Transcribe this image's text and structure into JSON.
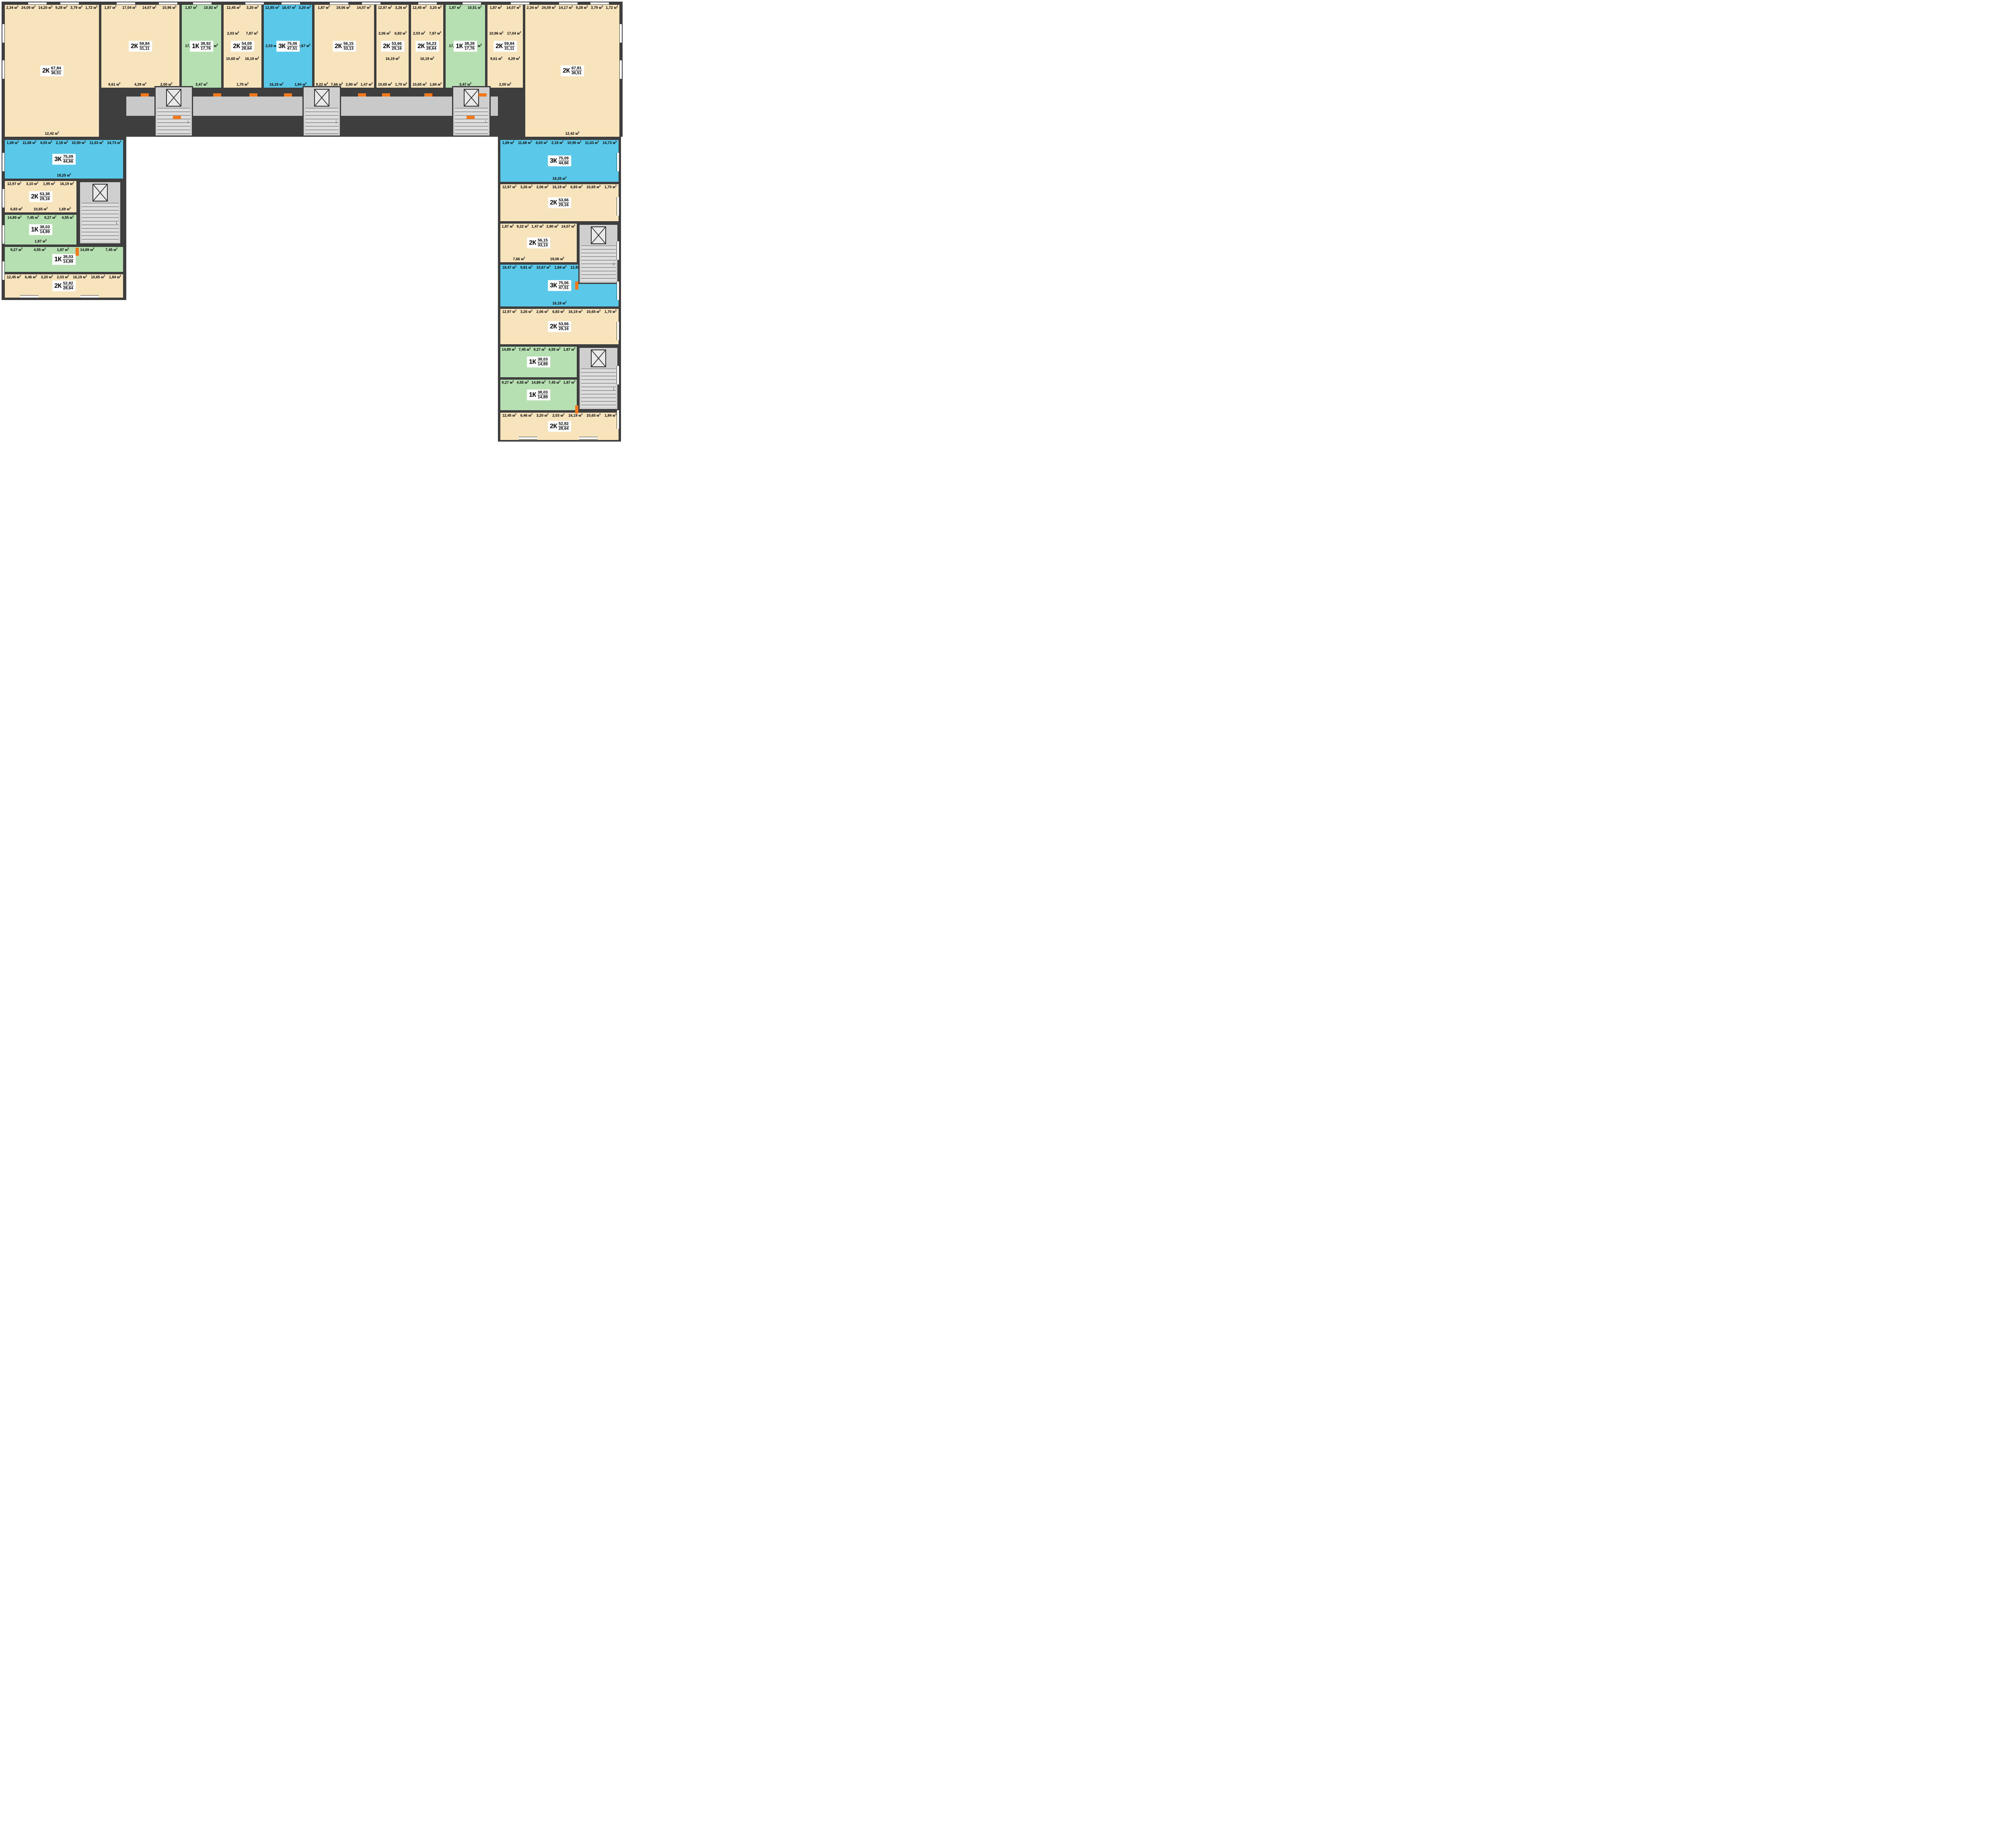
{
  "unit": "м²",
  "colors": {
    "wall": "#3e3e3e",
    "room_beige": "#f7e3bc",
    "room_green": "#b7e0b2",
    "room_blue": "#5ac8e8",
    "corridor_gray": "#c9c9c9",
    "accent_orange": "#f2781a",
    "badge_bg": "#ffffff",
    "text": "#000000"
  },
  "apartments": [
    {
      "id": "top-1",
      "type": "2К",
      "total": "67,84",
      "living": "36,51",
      "palette": "beige",
      "rooms": [
        {
          "name": "balcony",
          "area": "2,34"
        },
        {
          "name": "living-room",
          "area": "24,09"
        },
        {
          "name": "kitchen",
          "area": "14,20"
        },
        {
          "name": "hallway",
          "area": "9,28"
        },
        {
          "name": "bathroom",
          "area": "3,79"
        },
        {
          "name": "wc",
          "area": "1,72"
        },
        {
          "name": "living-room",
          "area": "12,42"
        }
      ]
    },
    {
      "id": "top-2",
      "type": "2К",
      "total": "59,84",
      "living": "31,11",
      "palette": "beige",
      "rooms": [
        {
          "name": "balcony",
          "area": "1,87"
        },
        {
          "name": "living-room",
          "area": "17,04"
        },
        {
          "name": "living-room",
          "area": "14,07"
        },
        {
          "name": "kitchen",
          "area": "10,96"
        },
        {
          "name": "hallway",
          "area": "9,61"
        },
        {
          "name": "bathroom",
          "area": "4,29"
        },
        {
          "name": "wc",
          "area": "2,00"
        }
      ]
    },
    {
      "id": "top-3",
      "type": "1К",
      "total": "38,92",
      "living": "17,76",
      "palette": "green",
      "rooms": [
        {
          "name": "balcony",
          "area": "1,87"
        },
        {
          "name": "kitchen",
          "area": "10,92"
        },
        {
          "name": "living-room",
          "area": "17,76"
        },
        {
          "name": "bathroom",
          "area": "4,90"
        },
        {
          "name": "hallway",
          "area": "3,47"
        }
      ]
    },
    {
      "id": "top-4",
      "type": "2К",
      "total": "54,09",
      "living": "28,64",
      "palette": "beige",
      "rooms": [
        {
          "name": "living-room",
          "area": "12,45"
        },
        {
          "name": "bathroom",
          "area": "3,20"
        },
        {
          "name": "wc",
          "area": "2,03"
        },
        {
          "name": "hallway",
          "area": "7,87"
        },
        {
          "name": "kitchen",
          "area": "10,65"
        },
        {
          "name": "living-room",
          "area": "16,19"
        },
        {
          "name": "balcony",
          "area": "1,70"
        }
      ]
    },
    {
      "id": "top-5",
      "type": "3К",
      "total": "75,06",
      "living": "47,51",
      "palette": "blue",
      "rooms": [
        {
          "name": "living-room",
          "area": "12,85"
        },
        {
          "name": "living-room",
          "area": "18,47"
        },
        {
          "name": "bathroom",
          "area": "3,20"
        },
        {
          "name": "wc",
          "area": "2,03"
        },
        {
          "name": "hallway",
          "area": "9,81"
        },
        {
          "name": "kitchen",
          "area": "10,67"
        },
        {
          "name": "living-room",
          "area": "16,19"
        },
        {
          "name": "balcony",
          "area": "1,84"
        }
      ]
    },
    {
      "id": "top-6",
      "type": "2К",
      "total": "56,15",
      "living": "33,13",
      "palette": "beige",
      "rooms": [
        {
          "name": "balcony",
          "area": "1,87"
        },
        {
          "name": "living-room",
          "area": "19,06"
        },
        {
          "name": "living-room",
          "area": "14,07"
        },
        {
          "name": "kitchen",
          "area": "9,22"
        },
        {
          "name": "hallway",
          "area": "7,66"
        },
        {
          "name": "bathroom",
          "area": "2,80"
        },
        {
          "name": "wc",
          "area": "1,47"
        }
      ]
    },
    {
      "id": "top-7",
      "type": "2К",
      "total": "53,66",
      "living": "29,16",
      "palette": "beige",
      "rooms": [
        {
          "name": "living-room",
          "area": "12,97"
        },
        {
          "name": "bathroom",
          "area": "3,26"
        },
        {
          "name": "wc",
          "area": "2,06"
        },
        {
          "name": "hallway",
          "area": "6,83"
        },
        {
          "name": "living-room",
          "area": "16,19"
        },
        {
          "name": "kitchen",
          "area": "10,65"
        },
        {
          "name": "balcony",
          "area": "1,70"
        }
      ]
    },
    {
      "id": "top-8",
      "type": "2К",
      "total": "54,23",
      "living": "28,64",
      "palette": "beige",
      "rooms": [
        {
          "name": "living-room",
          "area": "12,45"
        },
        {
          "name": "bathroom",
          "area": "3,20"
        },
        {
          "name": "wc",
          "area": "2,03"
        },
        {
          "name": "hallway",
          "area": "7,87"
        },
        {
          "name": "living-room",
          "area": "16,19"
        },
        {
          "name": "kitchen",
          "area": "10,65"
        },
        {
          "name": "balcony",
          "area": "1,84"
        }
      ]
    },
    {
      "id": "top-9",
      "type": "1К",
      "total": "38,28",
      "living": "17,76",
      "palette": "green",
      "rooms": [
        {
          "name": "balcony",
          "area": "1,87"
        },
        {
          "name": "kitchen",
          "area": "10,51"
        },
        {
          "name": "living-room",
          "area": "17,76"
        },
        {
          "name": "bathroom",
          "area": "4,67"
        },
        {
          "name": "hallway",
          "area": "3,47"
        }
      ]
    },
    {
      "id": "top-10",
      "type": "2К",
      "total": "59,84",
      "living": "31,11",
      "palette": "beige",
      "rooms": [
        {
          "name": "balcony",
          "area": "1,87"
        },
        {
          "name": "living-room",
          "area": "14,07"
        },
        {
          "name": "kitchen",
          "area": "10,96"
        },
        {
          "name": "living-room",
          "area": "17,04"
        },
        {
          "name": "hallway",
          "area": "9,61"
        },
        {
          "name": "bathroom",
          "area": "4,29"
        },
        {
          "name": "wc",
          "area": "2,00"
        }
      ]
    },
    {
      "id": "top-11",
      "type": "2К",
      "total": "67,81",
      "living": "36,51",
      "palette": "beige",
      "rooms": [
        {
          "name": "balcony",
          "area": "2,34"
        },
        {
          "name": "living-room",
          "area": "24,09"
        },
        {
          "name": "kitchen",
          "area": "14,17"
        },
        {
          "name": "hallway",
          "area": "9,28"
        },
        {
          "name": "bathroom",
          "area": "3,79"
        },
        {
          "name": "wc",
          "area": "1,72"
        },
        {
          "name": "living-room",
          "area": "12,42"
        }
      ]
    },
    {
      "id": "left-1",
      "type": "3К",
      "total": "75,09",
      "living": "44,66",
      "palette": "blue",
      "rooms": [
        {
          "name": "balcony",
          "area": "1,69"
        },
        {
          "name": "living-room",
          "area": "11,68"
        },
        {
          "name": "bathroom",
          "area": "4,03"
        },
        {
          "name": "wc",
          "area": "2,18"
        },
        {
          "name": "kitchen",
          "area": "10,90"
        },
        {
          "name": "hallway",
          "area": "11,63"
        },
        {
          "name": "living-room",
          "area": "14,73"
        },
        {
          "name": "living-room",
          "area": "18,25"
        }
      ]
    },
    {
      "id": "left-2",
      "type": "2К",
      "total": "53,38",
      "living": "29,16",
      "palette": "beige",
      "rooms": [
        {
          "name": "living-room",
          "area": "12,97"
        },
        {
          "name": "bathroom",
          "area": "3,10"
        },
        {
          "name": "wc",
          "area": "1,95"
        },
        {
          "name": "living-room",
          "area": "16,19"
        },
        {
          "name": "hallway",
          "area": "6,83"
        },
        {
          "name": "kitchen",
          "area": "10,65"
        },
        {
          "name": "balcony",
          "area": "1,69"
        }
      ]
    },
    {
      "id": "left-3",
      "type": "1К",
      "total": "38,03",
      "living": "14,89",
      "palette": "green",
      "rooms": [
        {
          "name": "living-room",
          "area": "14,89"
        },
        {
          "name": "hallway",
          "area": "7,45"
        },
        {
          "name": "kitchen",
          "area": "9,27"
        },
        {
          "name": "bathroom",
          "area": "4,55"
        },
        {
          "name": "balcony",
          "area": "1,87"
        }
      ]
    },
    {
      "id": "left-4",
      "type": "1К",
      "total": "38,03",
      "living": "14,89",
      "palette": "green",
      "rooms": [
        {
          "name": "kitchen",
          "area": "9,27"
        },
        {
          "name": "bathroom",
          "area": "4,55"
        },
        {
          "name": "balcony",
          "area": "1,87"
        },
        {
          "name": "living-room",
          "area": "14,89"
        },
        {
          "name": "hallway",
          "area": "7,45"
        }
      ]
    },
    {
      "id": "left-5",
      "type": "2К",
      "total": "52,82",
      "living": "28,64",
      "palette": "beige",
      "rooms": [
        {
          "name": "living-room",
          "area": "12,45"
        },
        {
          "name": "hallway",
          "area": "6,46"
        },
        {
          "name": "bathroom",
          "area": "3,20"
        },
        {
          "name": "wc",
          "area": "2,03"
        },
        {
          "name": "living-room",
          "area": "16,19"
        },
        {
          "name": "kitchen",
          "area": "10,65"
        },
        {
          "name": "balcony",
          "area": "1,84"
        }
      ]
    },
    {
      "id": "right-1",
      "type": "3К",
      "total": "75,09",
      "living": "44,66",
      "palette": "blue",
      "rooms": [
        {
          "name": "balcony",
          "area": "1,69"
        },
        {
          "name": "living-room",
          "area": "11,68"
        },
        {
          "name": "bathroom",
          "area": "4,03"
        },
        {
          "name": "wc",
          "area": "2,18"
        },
        {
          "name": "kitchen",
          "area": "10,90"
        },
        {
          "name": "hallway",
          "area": "11,63"
        },
        {
          "name": "living-room",
          "area": "14,73"
        },
        {
          "name": "living-room",
          "area": "18,25"
        }
      ]
    },
    {
      "id": "right-2",
      "type": "2К",
      "total": "53,66",
      "living": "29,16",
      "palette": "beige",
      "rooms": [
        {
          "name": "living-room",
          "area": "12,97"
        },
        {
          "name": "bathroom",
          "area": "3,26"
        },
        {
          "name": "wc",
          "area": "2,06"
        },
        {
          "name": "living-room",
          "area": "16,19"
        },
        {
          "name": "hallway",
          "area": "6,83"
        },
        {
          "name": "kitchen",
          "area": "10,65"
        },
        {
          "name": "balcony",
          "area": "1,70"
        }
      ]
    },
    {
      "id": "right-3",
      "type": "2К",
      "total": "56,15",
      "living": "33,13",
      "palette": "beige",
      "rooms": [
        {
          "name": "balcony",
          "area": "1,87"
        },
        {
          "name": "kitchen",
          "area": "9,22"
        },
        {
          "name": "wc",
          "area": "1,47"
        },
        {
          "name": "bathroom",
          "area": "2,80"
        },
        {
          "name": "living-room",
          "area": "14,07"
        },
        {
          "name": "hallway",
          "area": "7,66"
        },
        {
          "name": "living-room",
          "area": "19,06"
        }
      ]
    },
    {
      "id": "right-4",
      "type": "3К",
      "total": "75,06",
      "living": "47,51",
      "palette": "blue",
      "rooms": [
        {
          "name": "living-room",
          "area": "18,47"
        },
        {
          "name": "hallway",
          "area": "9,81"
        },
        {
          "name": "kitchen",
          "area": "10,67"
        },
        {
          "name": "balcony",
          "area": "1,84"
        },
        {
          "name": "living-room",
          "area": "12,85"
        },
        {
          "name": "bathroom",
          "area": "3,20"
        },
        {
          "name": "wc",
          "area": "2,03"
        },
        {
          "name": "living-room",
          "area": "16,19"
        }
      ]
    },
    {
      "id": "right-5",
      "type": "2К",
      "total": "53,66",
      "living": "29,16",
      "palette": "beige",
      "rooms": [
        {
          "name": "living-room",
          "area": "12,97"
        },
        {
          "name": "bathroom",
          "area": "3,26"
        },
        {
          "name": "wc",
          "area": "2,06"
        },
        {
          "name": "hallway",
          "area": "6,83"
        },
        {
          "name": "living-room",
          "area": "16,19"
        },
        {
          "name": "kitchen",
          "area": "10,65"
        },
        {
          "name": "balcony",
          "area": "1,70"
        }
      ]
    },
    {
      "id": "right-6",
      "type": "1К",
      "total": "38,03",
      "living": "14,89",
      "palette": "green",
      "rooms": [
        {
          "name": "living-room",
          "area": "14,89"
        },
        {
          "name": "hallway",
          "area": "7,45"
        },
        {
          "name": "kitchen",
          "area": "9,27"
        },
        {
          "name": "bathroom",
          "area": "4,55"
        },
        {
          "name": "balcony",
          "area": "1,87"
        }
      ]
    },
    {
      "id": "right-7",
      "type": "1К",
      "total": "38,03",
      "living": "14,89",
      "palette": "green",
      "rooms": [
        {
          "name": "kitchen",
          "area": "9,27"
        },
        {
          "name": "bathroom",
          "area": "4,55"
        },
        {
          "name": "living-room",
          "area": "14,89"
        },
        {
          "name": "hallway",
          "area": "7,45"
        },
        {
          "name": "balcony",
          "area": "1,87"
        }
      ]
    },
    {
      "id": "right-8",
      "type": "2К",
      "total": "52,82",
      "living": "28,64",
      "palette": "beige",
      "rooms": [
        {
          "name": "living-room",
          "area": "12,45"
        },
        {
          "name": "hallway",
          "area": "6,46"
        },
        {
          "name": "bathroom",
          "area": "3,20"
        },
        {
          "name": "wc",
          "area": "2,03"
        },
        {
          "name": "living-room",
          "area": "16,19"
        },
        {
          "name": "kitchen",
          "area": "10,65"
        },
        {
          "name": "balcony",
          "area": "1,84"
        }
      ]
    }
  ]
}
